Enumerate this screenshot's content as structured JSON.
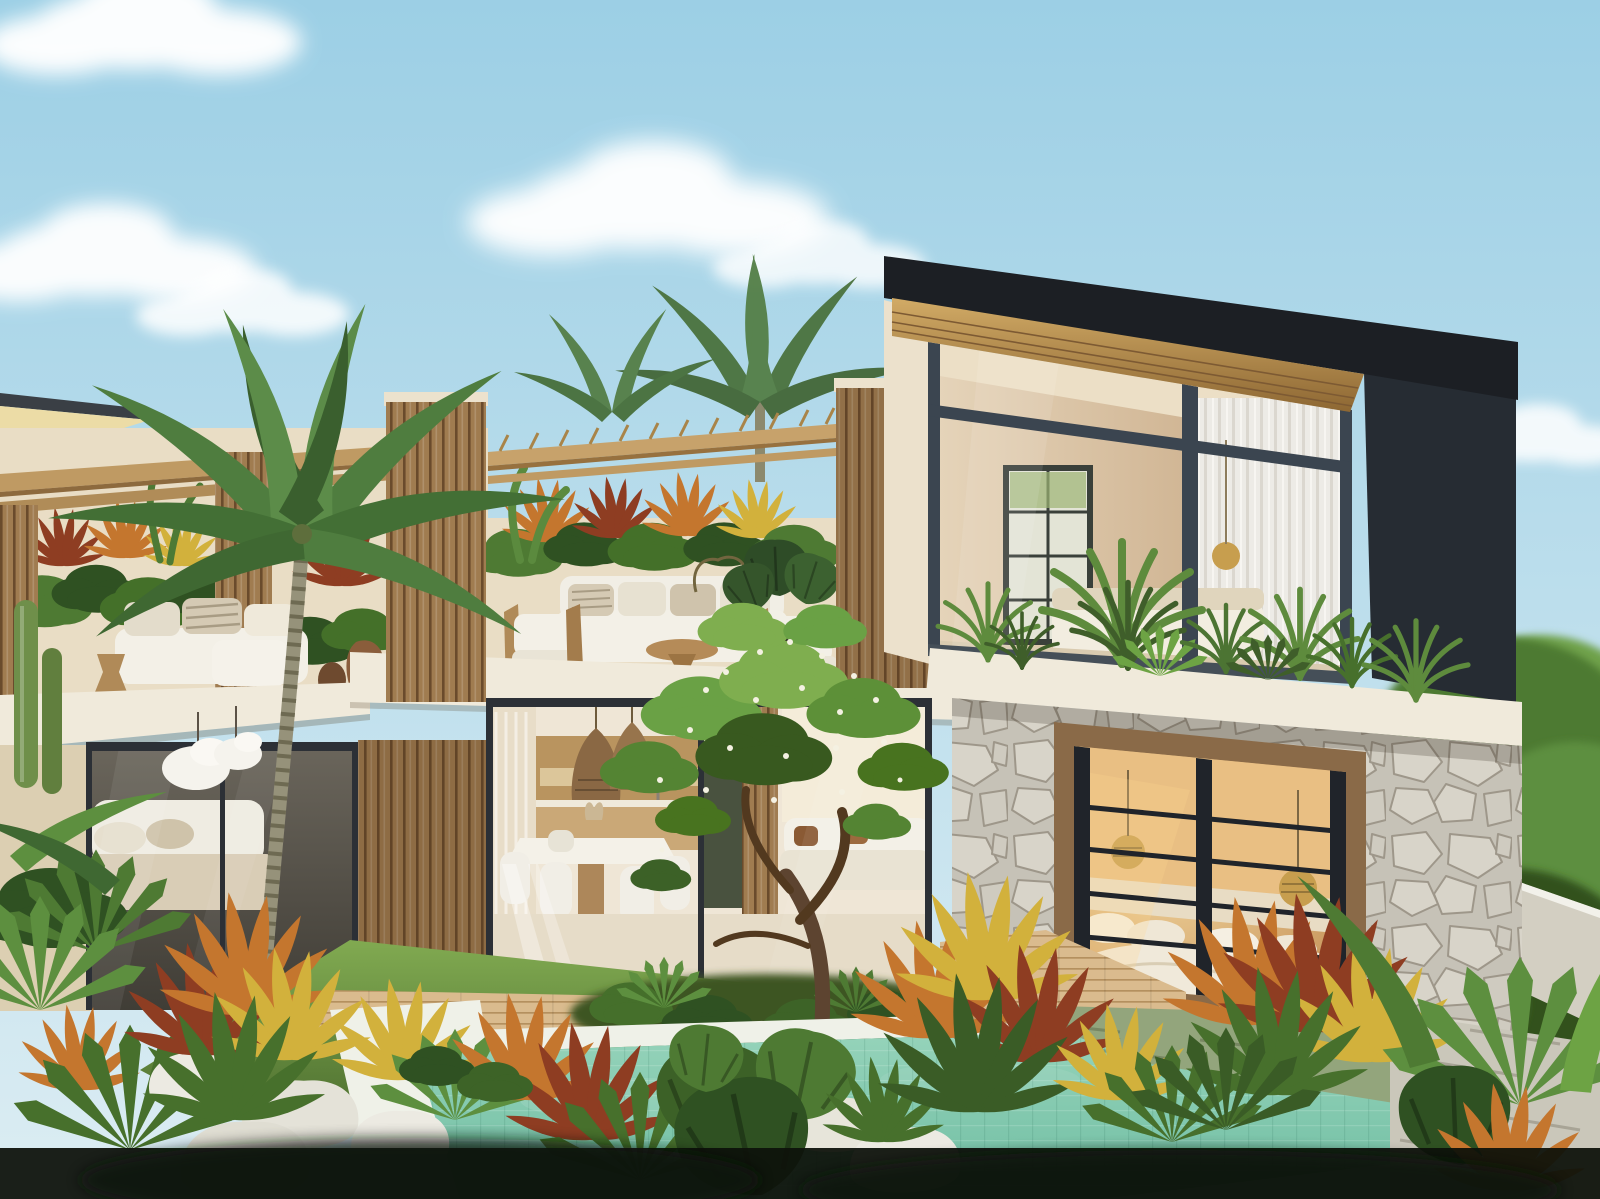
{
  "meta": {
    "scene": "3D architectural rendering of a tropical modern two-storey villa with rooftop terrace, courtyard garden and swimming pool",
    "time_of_day": "sunny daytime, clear sky with scattered cumulus clouds"
  },
  "palette": {
    "sky_top": "#9ccfe5",
    "sky_bottom": "#dcedf3",
    "cloud_white": "#ffffff",
    "roof_dark": "#1c1f24",
    "side_dark": "#262c33",
    "soffit_light": "#d2ab66",
    "soffit_dark": "#8d6733",
    "mullion": "#3b4550",
    "frame_black": "#20242a",
    "glass_cool": "#ccd4d1",
    "curtain": "#edebe6",
    "interior_wall": "#d9c2a0",
    "stucco": "#e9ddc5",
    "stucco_shade": "#dccfb2",
    "slab_white": "#f0eadb",
    "fascia_under": "#ecdca6",
    "slat_wood": "#a07c50",
    "slat_line": "#6a4b2c",
    "beam_wood": "#bf9a63",
    "stone_base": "#c6c2b7",
    "stone_light": "#d8d4c9",
    "stone_line": "#9e978a",
    "window_wood": "#8a6a48",
    "bedroom_glow": "#e9bf83",
    "rattan": "#c79e4e",
    "pool_light": "#97d4bb",
    "pool_deep": "#6fbda2",
    "coping": "#eff1e8",
    "lawn_light": "#81aa51",
    "lawn_dark": "#4e7030",
    "deck_wood": "#dabb8e",
    "deck_line": "#b4905f",
    "paving": "#cac7ba",
    "moss_paving": "#93a57c",
    "canopy": "#6aa145",
    "canopy_dark": "#38591f",
    "blossom": "#f4f1e2",
    "trunk_brown": "#5d4430",
    "palm_frond": "#4f7d3f",
    "palm_frond_dark": "#3a5f2e",
    "palm_trunk": "#96927a",
    "croton_orange": "#c4762e",
    "croton_yellow": "#d2b13c",
    "croton_red": "#8e3d22",
    "croton_green": "#47702c",
    "bush_green": "#4e7a33",
    "bush_dark": "#2f5122",
    "fern": "#5d8f3f",
    "balcony_plant": "#5e8b3d",
    "balcony_plant_dark": "#3f5e2a",
    "rock_white": "#eceae2",
    "sofa_white": "#f3f0e7",
    "cushion": "#d5cab4",
    "wood_furniture": "#b08a58",
    "pot_clay": "#8a5d3b",
    "pot_dark": "#2e2a24",
    "lamp_white": "#f5f3ed",
    "cactus": "#6f8f4a",
    "fridge_green": "#49523f",
    "cabinet_wood": "#b9945f",
    "glass_dark": "#57534a",
    "shadow_band": "#0e120b"
  },
  "scene": {
    "sky": {
      "description": "light blue sky, white cumulus clouds upper-left, centre and right"
    },
    "left_villa": {
      "features": [
        "angled roof edge at far left",
        "rooftop pergola with wood beams",
        "vertical wood slat screens",
        "white daybed with striped cushions",
        "white lounge chair",
        "hourglass wood stool",
        "clay amphora pots",
        "tropical hedge planter",
        "white concrete slab edge",
        "dark glass living room with beige sofa",
        "two white pendant lamps",
        "columnar cacti",
        "tall coconut palm in front"
      ]
    },
    "middle_wing": {
      "features": [
        "bamboo pergola over roof terrace",
        "planter hedge of crotons and banana plants",
        "white modular outdoor sofa",
        "two teak armchairs with white cushions",
        "hourglass side table",
        "potted dark green plant",
        "open-plan kitchen and dining behind glass sliders",
        "two rattan pendant lights",
        "white dining table with curved chairs",
        "dark green cabinet",
        "living sofa with brown cushions",
        "wood deck strip",
        "flowering frangipani courtyard tree"
      ]
    },
    "right_wing": {
      "features": [
        "mono-pitched black roof with wood soffit",
        "floor-to-ceiling glazing with dark mullions",
        "sheer white curtains",
        "interior gridded window",
        "gold pendant light",
        "balcony planter of dracaena and agave",
        "white balcony slab",
        "random stone cladding",
        "wood-framed bedroom picture window with black bars",
        "bed with white linen and pillows",
        "two rattan pendant lamps",
        "warm interior lighting"
      ]
    },
    "garden": {
      "features": [
        "green lawn",
        "white boulders",
        "turquoise tiled swimming pool with white coping",
        "wood pool deck",
        "mossy and grey stone paving",
        "croton border in orange, yellow and red",
        "fan palms and ferns",
        "monstera leaves",
        "dense jungle trees behind boundary wall",
        "dark foreground shadow band"
      ]
    }
  }
}
